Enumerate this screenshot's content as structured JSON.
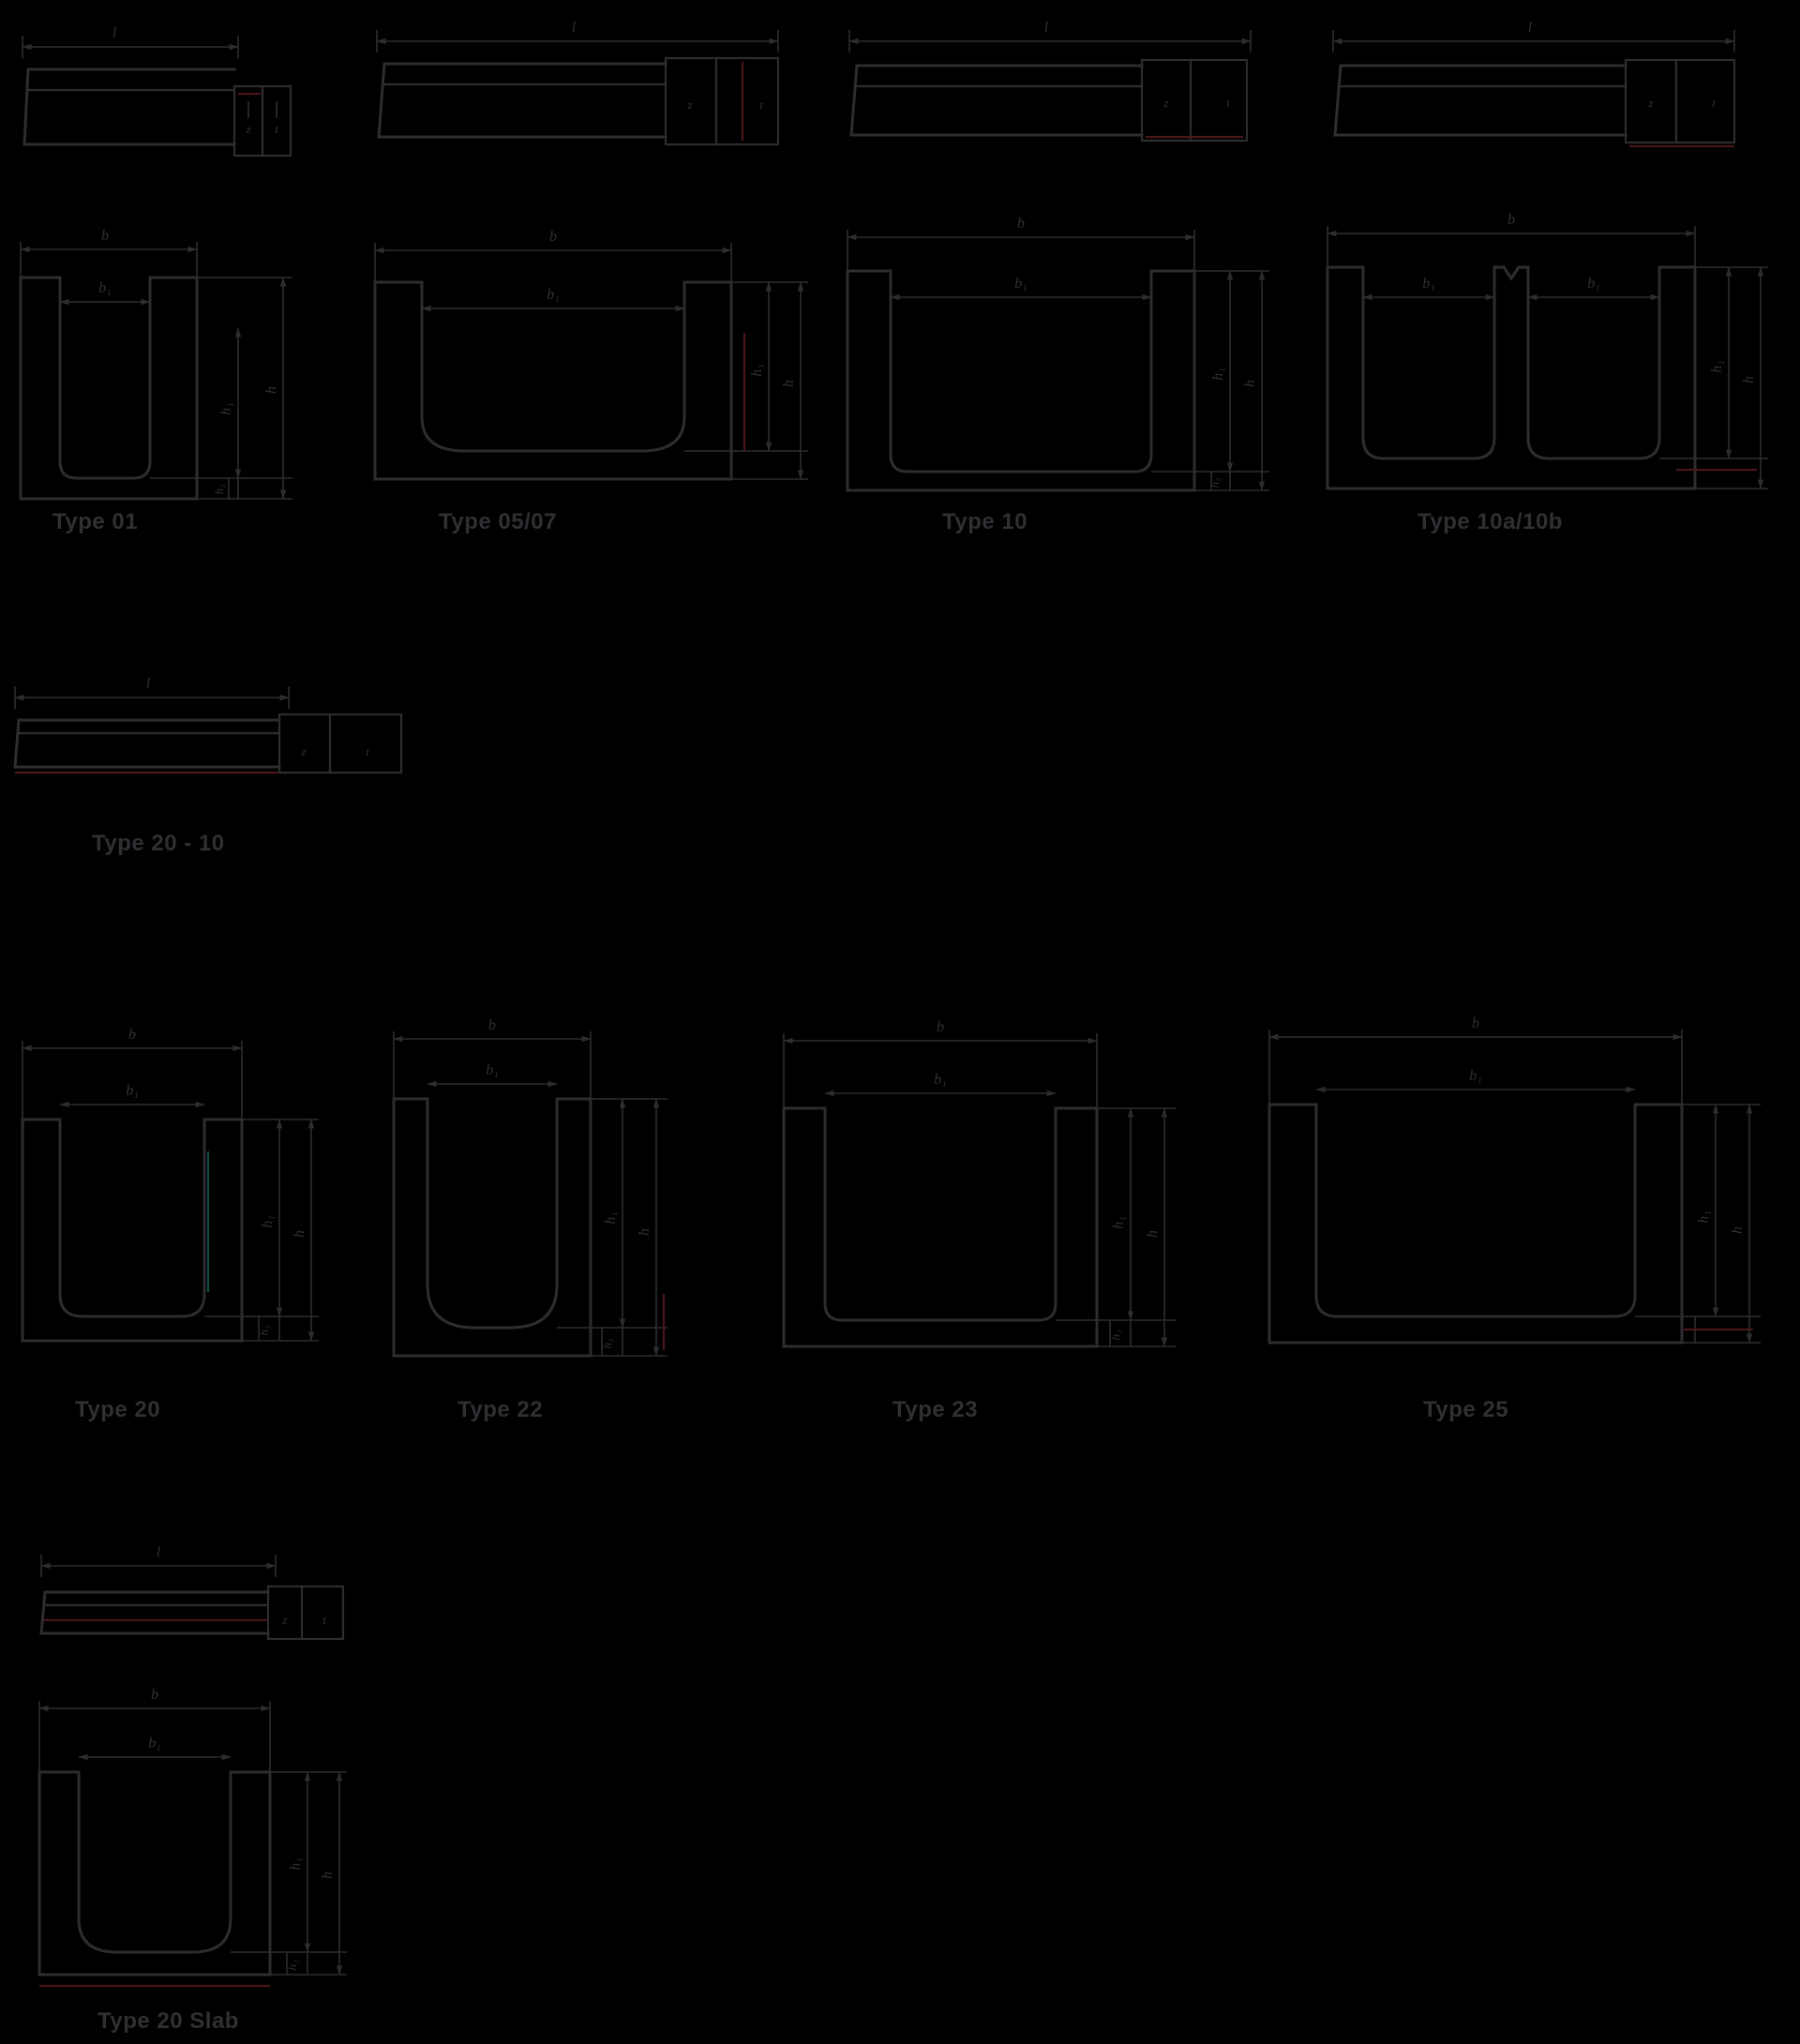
{
  "theme": {
    "background": "#000000",
    "line": "#2d2d30",
    "text": "#303034",
    "accent_red": "#4a1619",
    "accent_teal": "#124a44"
  },
  "dim_labels": {
    "length": "l",
    "width": "b",
    "inner_width": "b₁",
    "height": "h",
    "inner_height": "h₁",
    "base_height": "h₂",
    "joint_a": "z",
    "joint_b": "t"
  },
  "figures": [
    {
      "id": "type-01",
      "caption": "Type 01"
    },
    {
      "id": "type-05-07",
      "caption": "Type 05/07"
    },
    {
      "id": "type-10",
      "caption": "Type 10"
    },
    {
      "id": "type-10a-10b",
      "caption": "Type 10a/10b"
    },
    {
      "id": "type-20-10",
      "caption": "Type 20 - 10"
    },
    {
      "id": "type-20",
      "caption": "Type 20"
    },
    {
      "id": "type-22",
      "caption": "Type 22"
    },
    {
      "id": "type-23",
      "caption": "Type 23"
    },
    {
      "id": "type-25",
      "caption": "Type 25"
    },
    {
      "id": "type-20-slab",
      "caption": "Type 20 Slab"
    }
  ]
}
